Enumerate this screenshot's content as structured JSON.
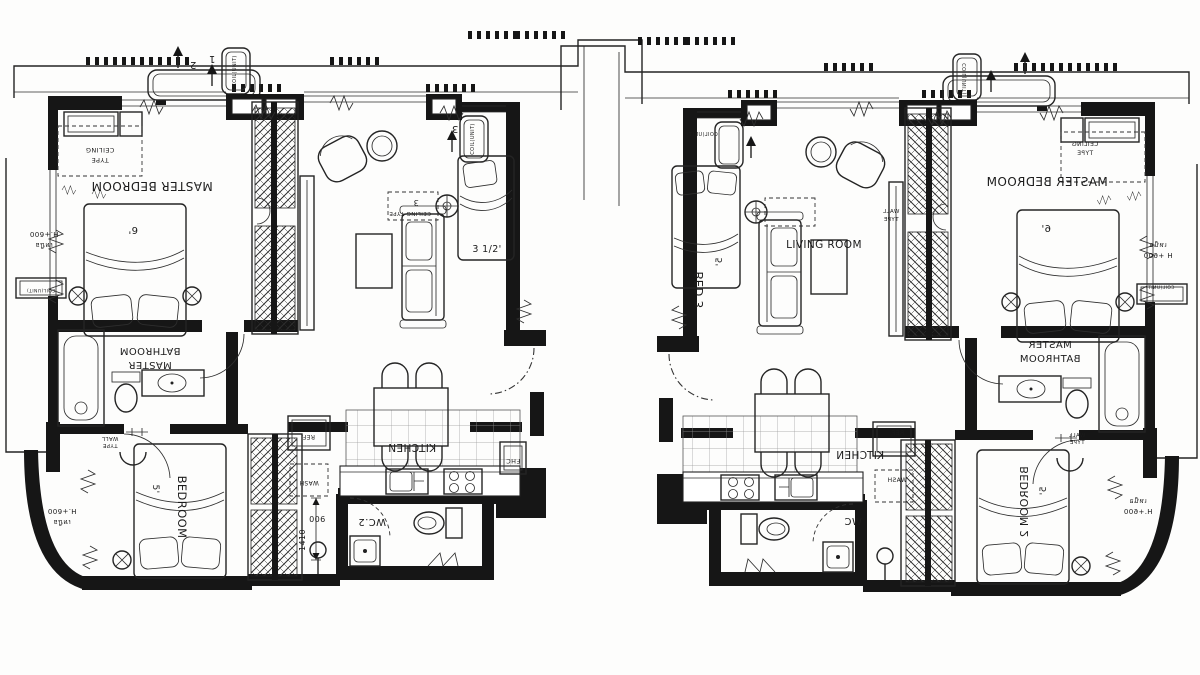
{
  "plan": {
    "type": "floor-plan",
    "colors": {
      "paper": "#fdfdfc",
      "ink": "#161616"
    },
    "units": [
      {
        "id": "left-unit",
        "labels": [
          {
            "name": "balcony-tag-2",
            "text": "2",
            "x": 193,
            "y": 62,
            "rot": 180,
            "mirror": false,
            "size": 10
          },
          {
            "name": "coil-unit-tag-1-text",
            "text": "COIL(UNIT)",
            "x": 236,
            "y": 71,
            "rot": 270,
            "mirror": false,
            "size": 5
          },
          {
            "name": "coil-unit-tag-1-num",
            "text": "1",
            "x": 212,
            "y": 56,
            "rot": 180,
            "mirror": false,
            "size": 10
          },
          {
            "name": "ceiling-type-label-1a",
            "text": "CEILING",
            "x": 100,
            "y": 148,
            "rot": 180,
            "mirror": false,
            "size": 6.5
          },
          {
            "name": "ceiling-type-label-1b",
            "text": "TYPE",
            "x": 100,
            "y": 158,
            "rot": 180,
            "mirror": false,
            "size": 6.5
          },
          {
            "name": "master-bedroom-label",
            "text": "MASTER BEDROOM",
            "x": 152,
            "y": 182,
            "rot": 180,
            "mirror": false,
            "size": 12
          },
          {
            "name": "master-bed-size",
            "text": "6'",
            "x": 133,
            "y": 227,
            "rot": 180,
            "mirror": false,
            "size": 10
          },
          {
            "name": "living-ceiling-num",
            "text": "3",
            "x": 416,
            "y": 200,
            "rot": 180,
            "mirror": false,
            "size": 8
          },
          {
            "name": "living-ceiling-label",
            "text": "CEILING TYPE",
            "x": 410,
            "y": 212,
            "rot": 180,
            "mirror": false,
            "size": 5.5
          },
          {
            "name": "coil-unit-tag-3-text",
            "text": "COIL(UNIT)",
            "x": 474,
            "y": 139,
            "rot": 270,
            "mirror": false,
            "size": 5
          },
          {
            "name": "coil-unit-tag-3-num",
            "text": "3",
            "x": 455,
            "y": 126,
            "rot": 180,
            "mirror": false,
            "size": 10
          },
          {
            "name": "bed3-size",
            "text": "3 1/2'",
            "x": 487,
            "y": 252,
            "rot": 0,
            "mirror": false,
            "size": 9.5
          },
          {
            "name": "master-bathroom-label-a",
            "text": "BATHROOM",
            "x": 150,
            "y": 348,
            "rot": 180,
            "mirror": false,
            "size": 10
          },
          {
            "name": "master-bathroom-label-b",
            "text": "MASTER",
            "x": 150,
            "y": 362,
            "rot": 180,
            "mirror": false,
            "size": 10
          },
          {
            "name": "wall-type-label-a",
            "text": "WALL",
            "x": 110,
            "y": 437,
            "rot": 180,
            "mirror": false,
            "size": 5.5
          },
          {
            "name": "wall-type-label-b",
            "text": "TYPE",
            "x": 110,
            "y": 444,
            "rot": 180,
            "mirror": false,
            "size": 5.5
          },
          {
            "name": "height-note-left-a",
            "text": "H.+600",
            "x": 44,
            "y": 232,
            "rot": 180,
            "mirror": false,
            "size": 7
          },
          {
            "name": "height-note-left-b",
            "text": "เหนือ",
            "x": 44,
            "y": 243,
            "rot": 180,
            "mirror": false,
            "size": 7
          },
          {
            "name": "coil-unit-box-left",
            "text": "COIL(UNIT)",
            "x": 41,
            "y": 289,
            "rot": 180,
            "mirror": false,
            "size": 4.5
          },
          {
            "name": "bedroom-label",
            "text": "BEDROOM",
            "x": 178,
            "y": 507,
            "rot": 90,
            "mirror": false,
            "size": 11.5
          },
          {
            "name": "bedroom-bed-size",
            "text": "5'",
            "x": 153,
            "y": 489,
            "rot": 90,
            "mirror": false,
            "size": 9
          },
          {
            "name": "kitchen-label",
            "text": "KITCHEN",
            "x": 412,
            "y": 444,
            "rot": 180,
            "mirror": false,
            "size": 10.5
          },
          {
            "name": "wc2-label",
            "text": "WC.2",
            "x": 372,
            "y": 519,
            "rot": 180,
            "mirror": false,
            "size": 10
          },
          {
            "name": "ref-label",
            "text": "REF.",
            "x": 308,
            "y": 435,
            "rot": 180,
            "mirror": false,
            "size": 6
          },
          {
            "name": "wash-label",
            "text": "WASH",
            "x": 309,
            "y": 481,
            "rot": 180,
            "mirror": false,
            "size": 6
          },
          {
            "name": "fhc-label",
            "text": "FHC",
            "x": 513,
            "y": 459,
            "rot": 180,
            "mirror": false,
            "size": 6.5
          },
          {
            "name": "dim-900",
            "text": "900",
            "x": 317,
            "y": 516,
            "rot": 180,
            "mirror": false,
            "size": 8
          },
          {
            "name": "dim-1410",
            "text": "1410",
            "x": 305,
            "y": 540,
            "rot": 270,
            "mirror": false,
            "size": 8
          },
          {
            "name": "height-note-curve-a",
            "text": "H.+600",
            "x": 62,
            "y": 509,
            "rot": 180,
            "mirror": false,
            "size": 7
          },
          {
            "name": "height-note-curve-b",
            "text": "เหนือ",
            "x": 62,
            "y": 520,
            "rot": 180,
            "mirror": false,
            "size": 7
          }
        ]
      },
      {
        "id": "right-unit",
        "labels": [
          {
            "name": "coil-unit-tag-top-left",
            "text": "COIL(UNIT)",
            "x": 702,
            "y": 136,
            "rot": 0,
            "mirror": true,
            "size": 5
          },
          {
            "name": "coil-unit-tag-vertical",
            "text": "COIL(UNIT)",
            "x": 966,
            "y": 79,
            "rot": 90,
            "mirror": true,
            "size": 5
          },
          {
            "name": "bed3-room-label",
            "text": "BED 3",
            "x": 703,
            "y": 290,
            "rot": 90,
            "mirror": true,
            "size": 11.5
          },
          {
            "name": "bed3-bed-size",
            "text": "5'",
            "x": 722,
            "y": 262,
            "rot": 90,
            "mirror": true,
            "size": 9
          },
          {
            "name": "living-room-label",
            "text": "LIVING ROOM",
            "x": 824,
            "y": 248,
            "rot": 0,
            "mirror": false,
            "size": 10.5
          },
          {
            "name": "wall-type-upper-a",
            "text": "WALL",
            "x": 891,
            "y": 213,
            "rot": 0,
            "mirror": true,
            "size": 5.5
          },
          {
            "name": "wall-type-upper-b",
            "text": "TYPE",
            "x": 891,
            "y": 221,
            "rot": 0,
            "mirror": true,
            "size": 5.5
          },
          {
            "name": "ceiling-type-label-a",
            "text": "CEILING",
            "x": 1085,
            "y": 146,
            "rot": 0,
            "mirror": true,
            "size": 6
          },
          {
            "name": "ceiling-type-label-b",
            "text": "TYPE",
            "x": 1085,
            "y": 155,
            "rot": 0,
            "mirror": true,
            "size": 6
          },
          {
            "name": "master-bedroom-label",
            "text": "MASTER BEDROOM",
            "x": 1047,
            "y": 186,
            "rot": 0,
            "mirror": true,
            "size": 12
          },
          {
            "name": "master-bed-size",
            "text": "6'",
            "x": 1046,
            "y": 232,
            "rot": 0,
            "mirror": true,
            "size": 10
          },
          {
            "name": "height-note-right-a",
            "text": "เหนือ",
            "x": 1158,
            "y": 247,
            "rot": 0,
            "mirror": true,
            "size": 7
          },
          {
            "name": "height-note-right-b",
            "text": "H +600",
            "x": 1158,
            "y": 258,
            "rot": 0,
            "mirror": true,
            "size": 7
          },
          {
            "name": "coil-unit-box-right",
            "text": "COIL(UNIT)",
            "x": 1160,
            "y": 289,
            "rot": 0,
            "mirror": true,
            "size": 4.5
          },
          {
            "name": "master-bathroom-label-a",
            "text": "MASTER",
            "x": 1050,
            "y": 348,
            "rot": 0,
            "mirror": true,
            "size": 10
          },
          {
            "name": "master-bathroom-label-b",
            "text": "BATHROOM",
            "x": 1050,
            "y": 362,
            "rot": 0,
            "mirror": true,
            "size": 10
          },
          {
            "name": "wall-type-lower-a",
            "text": "WALL",
            "x": 1077,
            "y": 437,
            "rot": 0,
            "mirror": true,
            "size": 5.5
          },
          {
            "name": "wall-type-lower-b",
            "text": "TYPE",
            "x": 1077,
            "y": 444,
            "rot": 0,
            "mirror": true,
            "size": 5.5
          },
          {
            "name": "bedroom2-label",
            "text": "BEDROOM 2",
            "x": 1028,
            "y": 502,
            "rot": 90,
            "mirror": true,
            "size": 11
          },
          {
            "name": "bedroom2-bed-size",
            "text": "5'",
            "x": 1046,
            "y": 491,
            "rot": 90,
            "mirror": true,
            "size": 9
          },
          {
            "name": "kitchen-label",
            "text": "KITCHEN",
            "x": 860,
            "y": 459,
            "rot": 0,
            "mirror": true,
            "size": 10.5
          },
          {
            "name": "ref-label",
            "text": "REF.",
            "x": 897,
            "y": 435,
            "rot": 0,
            "mirror": true,
            "size": 6
          },
          {
            "name": "wash-label",
            "text": "WASH",
            "x": 897,
            "y": 482,
            "rot": 0,
            "mirror": true,
            "size": 6
          },
          {
            "name": "wc-label",
            "text": "WC",
            "x": 853,
            "y": 525,
            "rot": 0,
            "mirror": true,
            "size": 10
          },
          {
            "name": "height-note-curve-a",
            "text": "เหนือ",
            "x": 1138,
            "y": 503,
            "rot": 0,
            "mirror": true,
            "size": 7
          },
          {
            "name": "height-note-curve-b",
            "text": "H.+600",
            "x": 1138,
            "y": 514,
            "rot": 0,
            "mirror": true,
            "size": 7
          }
        ]
      }
    ]
  }
}
